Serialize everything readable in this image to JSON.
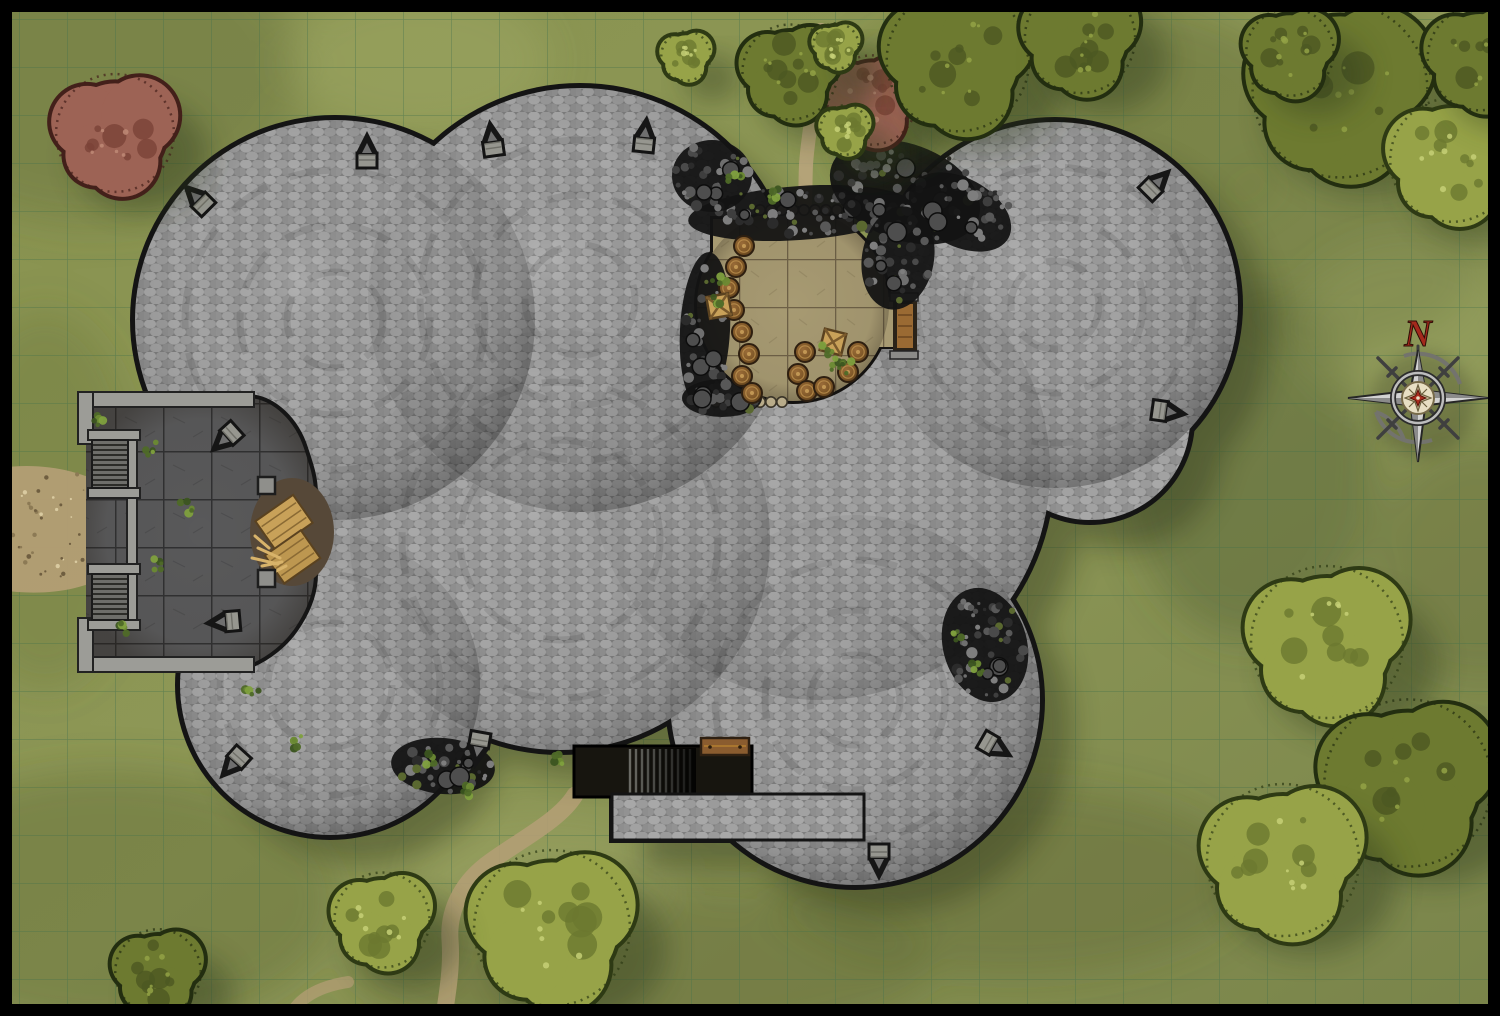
{
  "compass": {
    "north_label": "N"
  },
  "palette": {
    "grass": "#8a9455",
    "grass_dark": "#5a6635",
    "grass_light": "#c3cc84",
    "grid_line": "#44714c",
    "stone": "#a3a3a3",
    "stone_edge": "#141414",
    "courtyard_tile": "#59595a",
    "breach_floor": "#a79a72",
    "rubble": "#141414",
    "path": "#b39e74",
    "wood": "#c8a159",
    "barrel": "#7c5526",
    "shadow": "#2f3a1c",
    "compass_red": "#a3291c",
    "frame": "#000000"
  },
  "grid": {
    "cell_px": 48,
    "offset_px": 19,
    "columns": 31,
    "rows": 21
  },
  "scene": {
    "trees": [
      {
        "cx": 115,
        "cy": 133,
        "r": 62,
        "tone": "red"
      },
      {
        "cx": 872,
        "cy": 100,
        "r": 47,
        "tone": "red"
      },
      {
        "cx": 686,
        "cy": 56,
        "r": 26,
        "tone": "light"
      },
      {
        "cx": 790,
        "cy": 72,
        "r": 50,
        "tone": "dark"
      },
      {
        "cx": 836,
        "cy": 46,
        "r": 24,
        "tone": "light"
      },
      {
        "cx": 845,
        "cy": 130,
        "r": 26,
        "tone": "light"
      },
      {
        "cx": 958,
        "cy": 60,
        "r": 75,
        "tone": "dark"
      },
      {
        "cx": 1080,
        "cy": 38,
        "r": 58,
        "tone": "dark"
      },
      {
        "cx": 1340,
        "cy": 90,
        "r": 92,
        "tone": "dark"
      },
      {
        "cx": 1452,
        "cy": 160,
        "r": 65,
        "tone": "light"
      },
      {
        "cx": 1290,
        "cy": 52,
        "r": 46,
        "tone": "dark"
      },
      {
        "cx": 1480,
        "cy": 58,
        "r": 55,
        "tone": "dark"
      },
      {
        "cx": 1327,
        "cy": 642,
        "r": 80,
        "tone": "light"
      },
      {
        "cx": 1408,
        "cy": 783,
        "r": 88,
        "tone": "dark"
      },
      {
        "cx": 1283,
        "cy": 860,
        "r": 80,
        "tone": "light"
      },
      {
        "cx": 552,
        "cy": 928,
        "r": 82,
        "tone": "light"
      },
      {
        "cx": 382,
        "cy": 920,
        "r": 50,
        "tone": "light"
      },
      {
        "cx": 158,
        "cy": 972,
        "r": 45,
        "tone": "dark"
      }
    ],
    "arrow_slits": [
      {
        "x": 196,
        "y": 197,
        "rot": 135
      },
      {
        "x": 367,
        "y": 150,
        "rot": 180
      },
      {
        "x": 492,
        "y": 138,
        "rot": 172
      },
      {
        "x": 645,
        "y": 134,
        "rot": 186
      },
      {
        "x": 1158,
        "y": 182,
        "rot": 225
      },
      {
        "x": 1170,
        "y": 412,
        "rot": 278
      },
      {
        "x": 224,
        "y": 440,
        "rot": 48
      },
      {
        "x": 222,
        "y": 622,
        "rot": 85
      },
      {
        "x": 232,
        "y": 765,
        "rot": 42
      },
      {
        "x": 997,
        "y": 748,
        "rot": 300
      },
      {
        "x": 879,
        "y": 862,
        "rot": 0
      },
      {
        "x": 478,
        "y": 750,
        "rot": 10
      }
    ],
    "barrels": [
      [
        744,
        246
      ],
      [
        736,
        267
      ],
      [
        729,
        288
      ],
      [
        734,
        310
      ],
      [
        742,
        332
      ],
      [
        749,
        354
      ],
      [
        742,
        376
      ],
      [
        752,
        393
      ],
      [
        805,
        352
      ],
      [
        798,
        374
      ],
      [
        807,
        391
      ],
      [
        824,
        387
      ],
      [
        848,
        372
      ],
      [
        858,
        352
      ]
    ],
    "crates": [
      [
        719,
        306,
        -10
      ],
      [
        833,
        342,
        14
      ]
    ],
    "plants": [
      [
        719,
        283
      ],
      [
        715,
        303
      ],
      [
        836,
        363
      ],
      [
        826,
        352
      ],
      [
        848,
        368
      ],
      [
        735,
        180
      ],
      [
        772,
        196
      ],
      [
        956,
        638
      ],
      [
        976,
        668
      ],
      [
        428,
        758
      ],
      [
        466,
        790
      ],
      [
        150,
        448
      ],
      [
        186,
        508
      ],
      [
        160,
        565
      ],
      [
        122,
        630
      ],
      [
        300,
        742
      ],
      [
        96,
        418
      ],
      [
        252,
        688
      ],
      [
        560,
        758
      ]
    ],
    "rubble_patches": [
      {
        "cx": 800,
        "cy": 213,
        "rx": 112,
        "ry": 27,
        "rot": -4,
        "n": 58
      },
      {
        "cx": 712,
        "cy": 176,
        "rx": 40,
        "ry": 36,
        "rot": 0,
        "n": 28
      },
      {
        "cx": 905,
        "cy": 192,
        "rx": 78,
        "ry": 48,
        "rot": 20,
        "n": 62
      },
      {
        "cx": 960,
        "cy": 212,
        "rx": 55,
        "ry": 34,
        "rot": 28,
        "n": 34
      },
      {
        "cx": 898,
        "cy": 258,
        "rx": 36,
        "ry": 52,
        "rot": 10,
        "n": 32
      },
      {
        "cx": 705,
        "cy": 330,
        "rx": 25,
        "ry": 78,
        "rot": 3,
        "n": 36
      },
      {
        "cx": 722,
        "cy": 398,
        "rx": 40,
        "ry": 19,
        "rot": 0,
        "n": 20
      },
      {
        "cx": 985,
        "cy": 645,
        "rx": 42,
        "ry": 58,
        "rot": -15,
        "n": 44
      },
      {
        "cx": 443,
        "cy": 766,
        "rx": 52,
        "ry": 28,
        "rot": 5,
        "n": 32
      }
    ],
    "scallop_rows": [
      {
        "x": 760,
        "y": 210,
        "count": 8,
        "step": 11
      },
      {
        "x": 716,
        "y": 402,
        "count": 7,
        "step": 11
      }
    ],
    "dirt_speckle_area": {
      "cx": 72,
      "cy": 530,
      "rx": 76,
      "ry": 56,
      "n": 70
    }
  }
}
